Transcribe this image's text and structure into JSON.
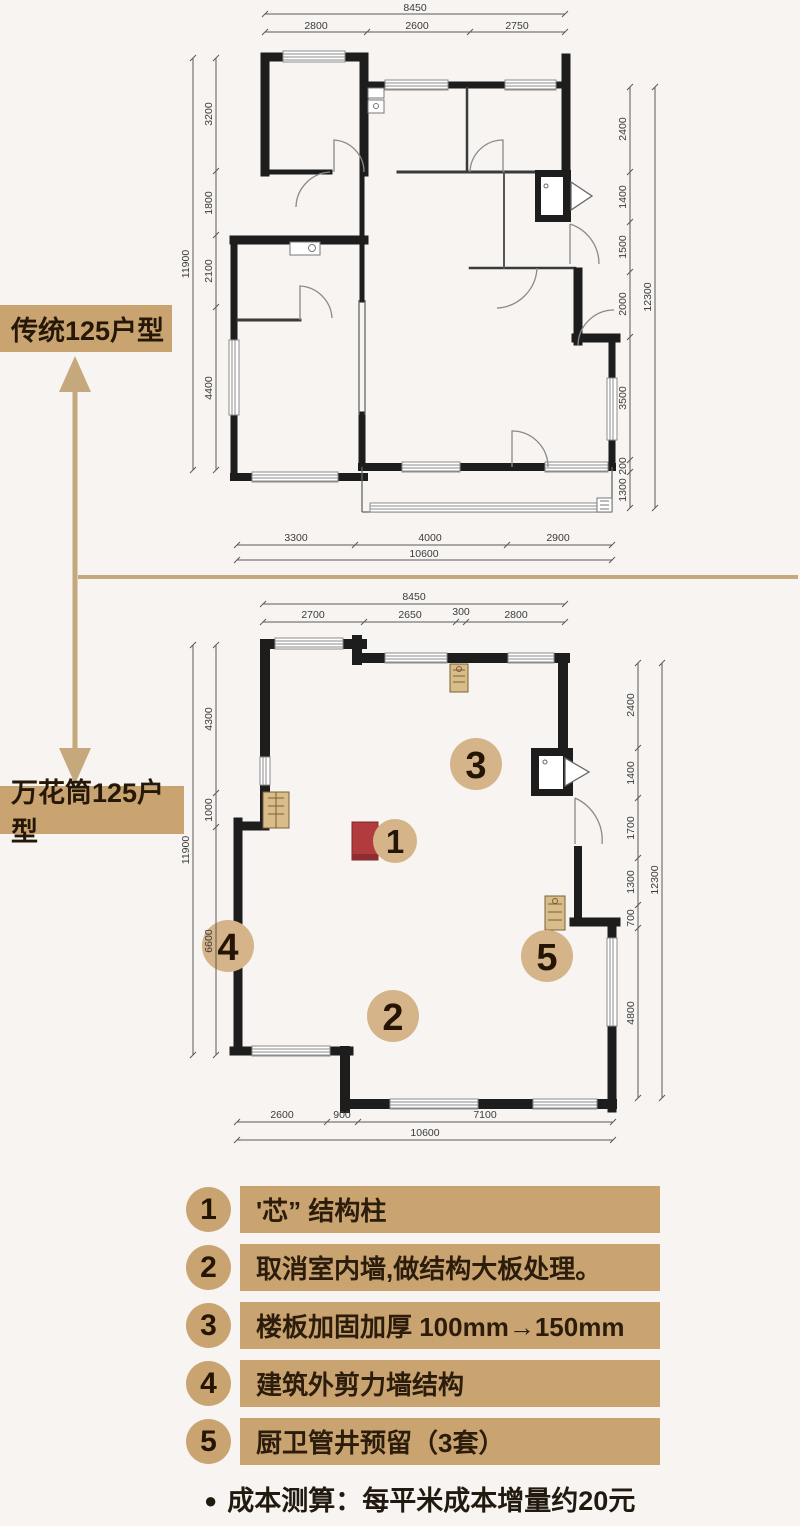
{
  "labels": {
    "top_plan": "传统125户型",
    "bottom_plan": "万花筒125户型"
  },
  "plan_top": {
    "dim_total_top": "8450",
    "dims_top": [
      "2800",
      "2600",
      "2750"
    ],
    "dim_total_left": "11900",
    "dims_left": [
      "3200",
      "1800",
      "2100",
      "4400"
    ],
    "dim_total_right": "12300",
    "dims_right": [
      "2400",
      "1400",
      "1500",
      "2000",
      "3500",
      "200",
      "1300"
    ],
    "dim_total_bottom": "10600",
    "dims_bottom": [
      "3300",
      "4000",
      "2900"
    ]
  },
  "plan_bottom": {
    "dim_total_top": "8450",
    "dims_top": [
      "2700",
      "2650",
      "300",
      "2800"
    ],
    "dim_total_left": "11900",
    "dims_left": [
      "4300",
      "1000",
      "6600"
    ],
    "dim_total_right": "12300",
    "dims_right": [
      "2400",
      "1400",
      "1700",
      "1300",
      "700",
      "4800"
    ],
    "dim_total_bottom": "10600",
    "dims_bottom": [
      "2600",
      "900",
      "7100"
    ],
    "markers": [
      "1",
      "2",
      "3",
      "4",
      "5"
    ]
  },
  "legend": {
    "items": [
      {
        "num": "1",
        "text": "'芯” 结构柱"
      },
      {
        "num": "2",
        "text": "取消室内墙,做结构大板处理。"
      },
      {
        "num": "3",
        "text": "楼板加固加厚 100mm→150mm"
      },
      {
        "num": "4",
        "text": "建筑外剪力墙结构"
      },
      {
        "num": "5",
        "text": "厨卫管井预留（3套）"
      }
    ],
    "footnote_bullet": "●",
    "footnote": "成本测算：每平米成本增量约20元"
  },
  "colors": {
    "accent_tan": "#c9a471",
    "marker_tan": "#d4b488",
    "wall_black": "#1d1d1d",
    "column_red": "#b23b3d"
  }
}
